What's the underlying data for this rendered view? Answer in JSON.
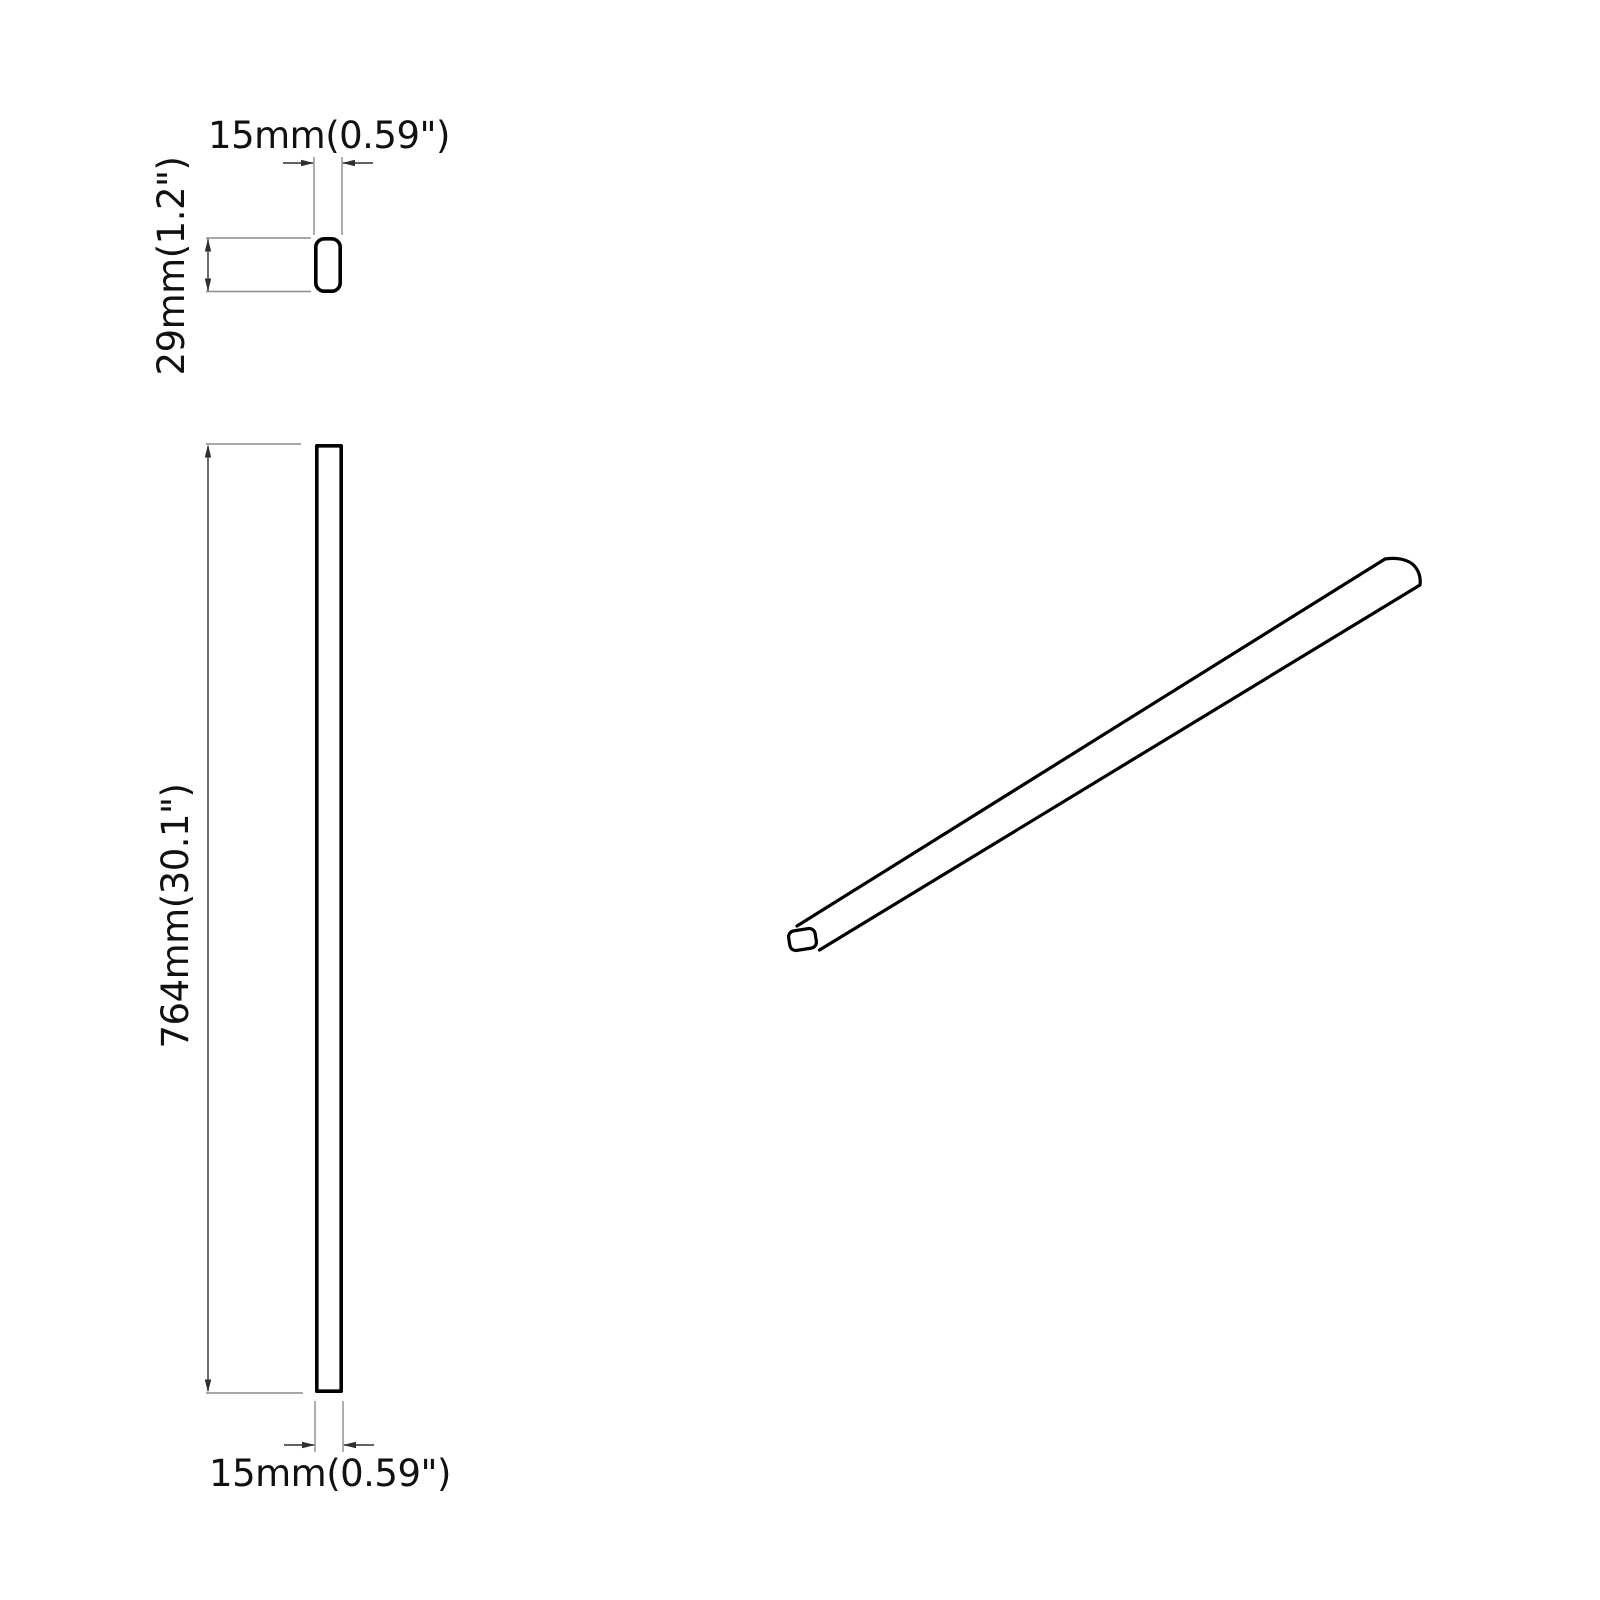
{
  "dimensions": {
    "cross_section_width": "15mm(0.59\")",
    "cross_section_height": "29mm(1.2\")",
    "front_length": "764mm(30.1\")",
    "front_width": "15mm(0.59\")"
  },
  "colors": {
    "background": "#ffffff",
    "object_line": "#000000",
    "dimension_line": "#2f2f2f",
    "extension_line": "#8c8c8c",
    "text": "#111111"
  }
}
